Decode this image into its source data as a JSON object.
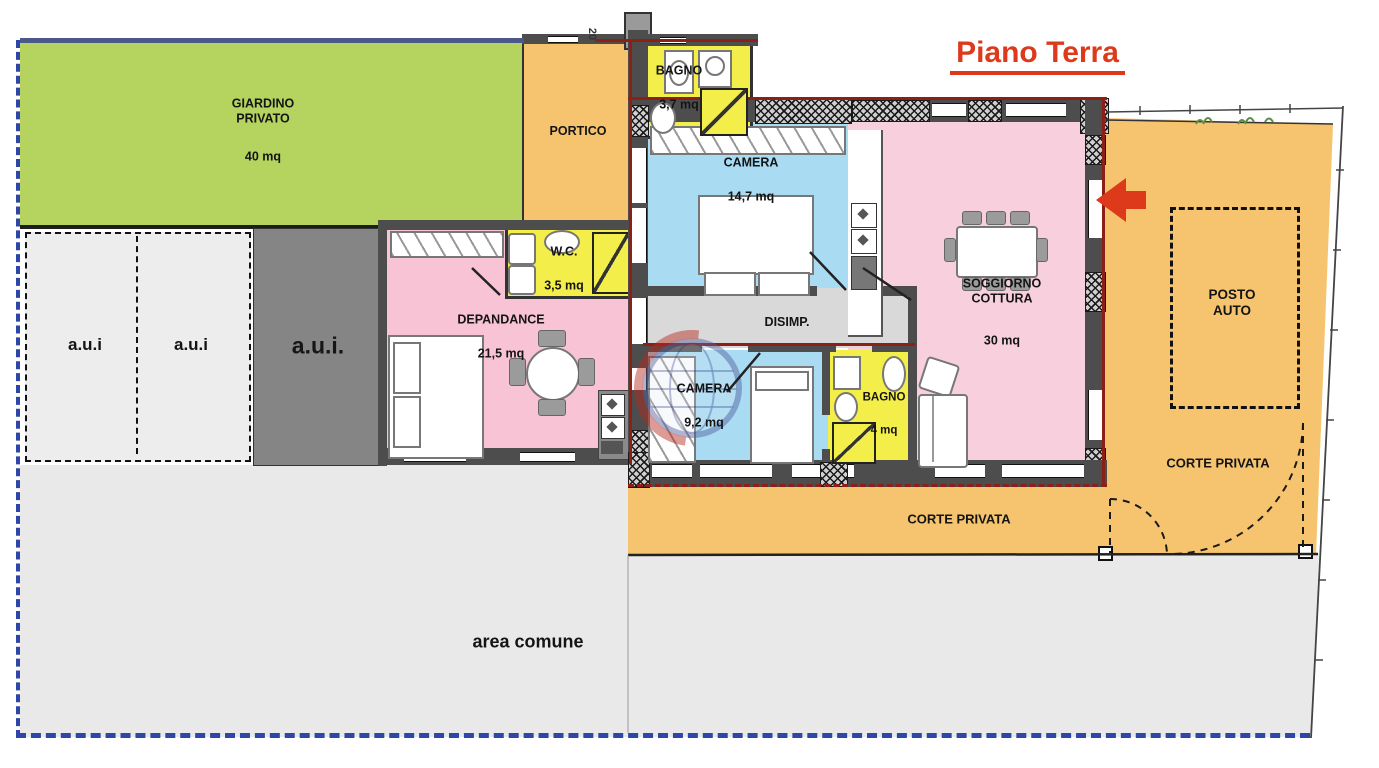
{
  "title": {
    "text": "Piano Terra"
  },
  "dimension_marks": {
    "top_wall": "20"
  },
  "colors": {
    "garden": "#b5d35f",
    "courtyard": "#f6c46e",
    "bathroom": "#f3ee49",
    "bedroom": "#a9dcf3",
    "living_pink": "#f7cfdd",
    "depandance_pink": "#f8c3d4",
    "hall_gray": "#d9d9d9",
    "common_gray": "#e9e9e9",
    "aui_light": "#ededed",
    "aui_dark": "#858585",
    "wall_gray": "#4d4d4d",
    "boundary_blue": "#2d46a8",
    "site_navy": "#4a5988",
    "accent_red": "#dd3a1b",
    "property_red": "#8e1f14"
  },
  "rooms": {
    "giardino": {
      "name": "GIARDINO\nPRIVATO",
      "area": "40 mq"
    },
    "portico": {
      "name": "PORTICO"
    },
    "bagno1": {
      "name": "BAGNO",
      "area": "3,7 mq"
    },
    "camera1": {
      "name": "CAMERA",
      "area": "14,7 mq"
    },
    "wc": {
      "name": "W.C.",
      "area": "3,5 mq"
    },
    "depandance": {
      "name": "DEPANDANCE",
      "area": "21,5 mq"
    },
    "soggiorno": {
      "name": "SOGGIORNO\nCOTTURA",
      "area": "30 mq"
    },
    "disimpegno": {
      "name": "DISIMP."
    },
    "camera2": {
      "name": "CAMERA",
      "area": "9,2 mq"
    },
    "bagno2": {
      "name": "BAGNO",
      "area": "4 mq"
    },
    "posto_auto": {
      "name": "POSTO\nAUTO"
    },
    "corte_privata_right": {
      "name": "CORTE PRIVATA"
    },
    "corte_privata_bottom": {
      "name": "CORTE PRIVATA"
    },
    "area_comune": {
      "name": "area comune"
    },
    "aui_left": {
      "name": "a.u.i"
    },
    "aui_middle": {
      "name": "a.u.i"
    },
    "aui_dark": {
      "name": "a.u.i."
    }
  }
}
